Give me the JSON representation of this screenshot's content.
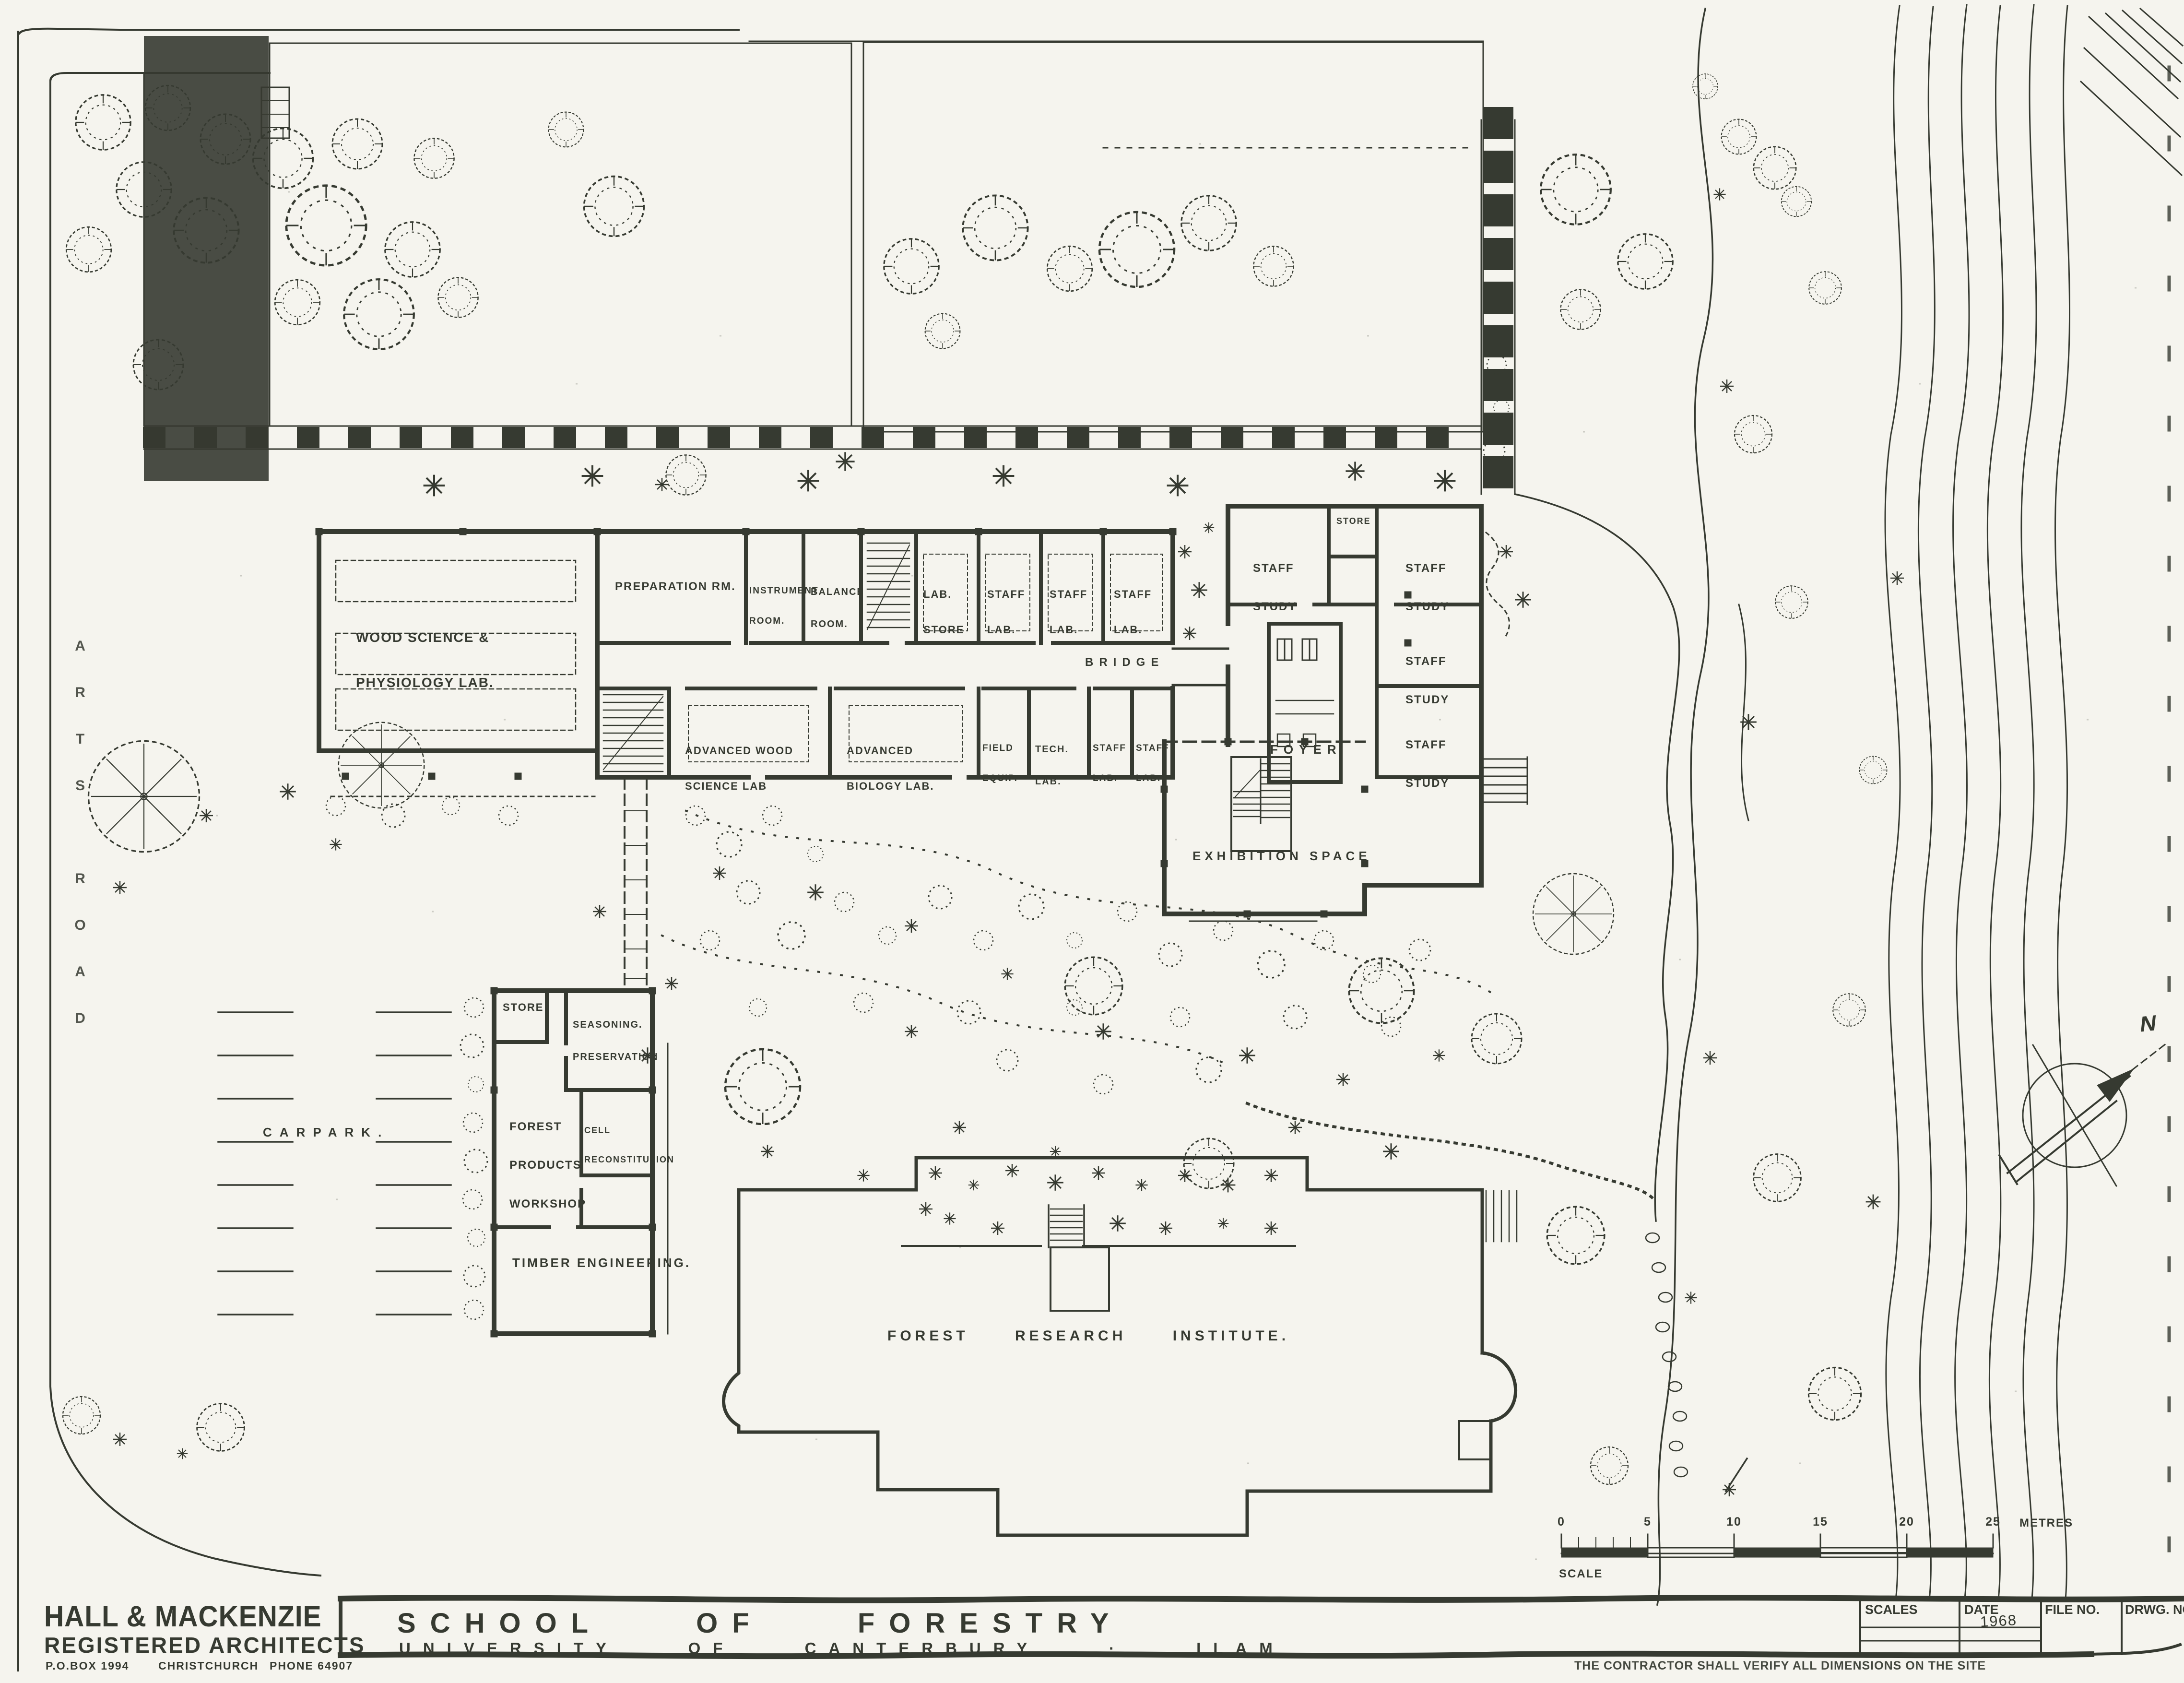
{
  "drawing": {
    "ink": "#363a31",
    "paper": "#f5f4ee",
    "title": {
      "main": "SCHOOL OF FORESTRY",
      "sub": "UNIVERSITY OF CANTERBURY · ILAM"
    },
    "architect": {
      "name": "HALL & MACKENZIE",
      "type": "REGISTERED ARCHITECTS",
      "po_box": "P.O.BOX 1994",
      "city": "CHRISTCHURCH",
      "phone": "PHONE 64907"
    },
    "titleblock": {
      "scales_label": "SCALES",
      "date_label": "DATE",
      "date_value": "1968",
      "file_label": "FILE NO.",
      "drwg_label": "DRWG. NO.",
      "note": "THE CONTRACTOR SHALL VERIFY ALL DIMENSIONS ON THE SITE"
    },
    "scalebar": {
      "ticks": [
        "0",
        "5",
        "10",
        "15",
        "20",
        "25"
      ],
      "unit": "METRES",
      "label": "SCALE"
    },
    "compass": {
      "north": "N"
    },
    "site": {
      "road": "ARTS ROAD",
      "carpark": "CARPARK.",
      "institute": "FOREST RESEARCH INSTITUTE.",
      "bridge": "BRIDGE"
    },
    "rooms": {
      "wood_science": [
        "WOOD SCIENCE &",
        "PHYSIOLOGY LAB."
      ],
      "preparation": "PREPARATION RM.",
      "instrument": [
        "INSTRUMENT",
        "ROOM."
      ],
      "balance": [
        "BALANCE",
        "ROOM."
      ],
      "lab_store": [
        "LAB.",
        "STORE"
      ],
      "staff_lab": [
        "STAFF",
        "LAB."
      ],
      "field_equip": [
        "FIELD",
        "EQUIP."
      ],
      "tech_lab": [
        "TECH.",
        "LAB."
      ],
      "staff_study": [
        "STAFF",
        "STUDY"
      ],
      "store_small": "STORE",
      "foyer": "FOYER",
      "exhibition": "EXHIBITION SPACE",
      "store": "STORE",
      "seasoning": [
        "SEASONING.",
        "PRESERVATION"
      ],
      "forest_products": [
        "FOREST",
        "PRODUCTS",
        "WORKSHOP"
      ],
      "cell_reconstitution": [
        "CELL",
        "RECONSTITUTION"
      ],
      "timber": "TIMBER ENGINEERING."
    }
  }
}
